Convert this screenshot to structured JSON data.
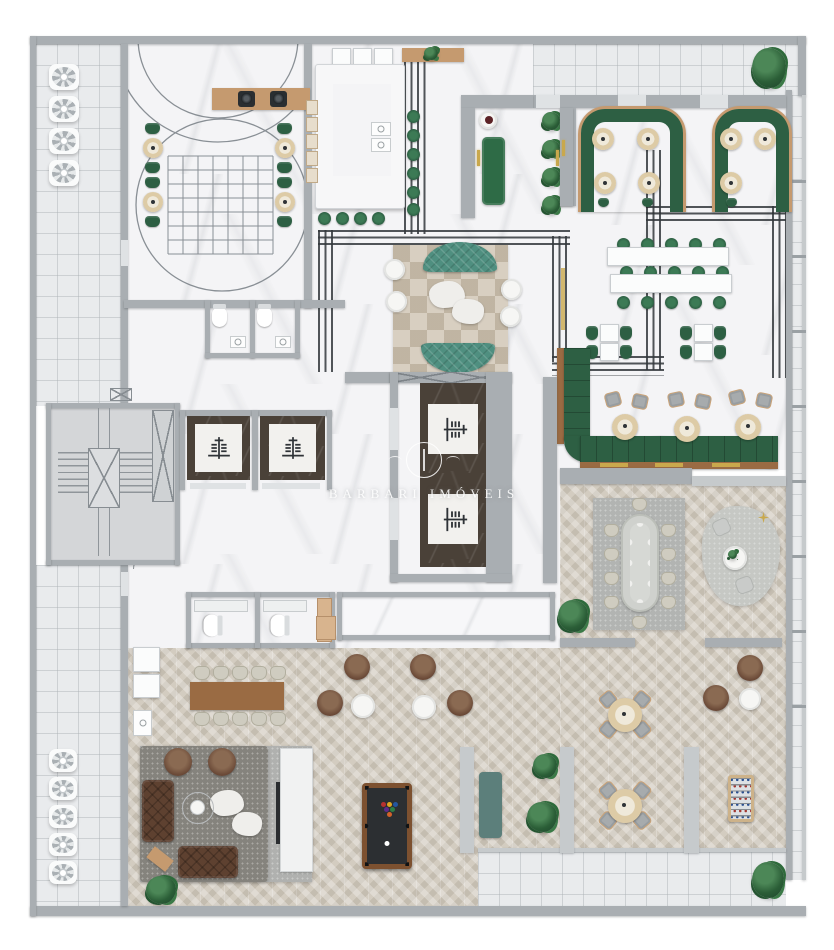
{
  "watermark": {
    "text": "BARBARI IMÓVEIS"
  },
  "palette": {
    "wall": "#a9aeb2",
    "wall_light": "#c6cacc",
    "marble": "#f4f4f6",
    "tile": "#e9ebed",
    "herringbone": "#d3ccc0",
    "wood": "#c59a6f",
    "wood_dark": "#9a6b43",
    "green": "#2d5f43",
    "green_bright": "#2e6b46",
    "teal": "#4f8f80",
    "teal_gray": "#5c7f7b",
    "leather": "#5e4130",
    "deco_line": "#33383c",
    "gold": "#c9a84c",
    "dark_marble": "#4a4138",
    "rug_dark": "#87857f",
    "rug_light": "#b7b8b6",
    "plant": "#2b5e37",
    "felt": "#2c2f32"
  },
  "zones": [
    "balcony-corridor-left",
    "gourmet-lounge",
    "kitchen",
    "entry-vestibule",
    "terrace-top",
    "restaurant-booths",
    "restaurant-communal",
    "restaurant-banquette",
    "center-lounge",
    "elevator-lobby",
    "stairwell",
    "restrooms-upper",
    "restrooms-lower",
    "private-dining",
    "reading-corner",
    "family-dining",
    "tv-lounge",
    "billiards-room",
    "games-room",
    "terrace-bottom",
    "balcony-right"
  ]
}
